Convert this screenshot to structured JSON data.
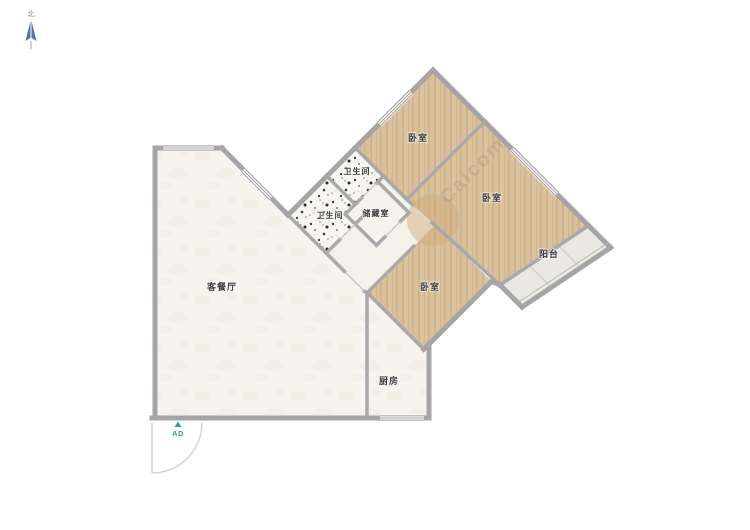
{
  "floorplan": {
    "compass_label": "北",
    "entry_marker": "AD",
    "watermark": "Caicom",
    "rooms": [
      {
        "id": "bedroom-top",
        "label": "卧室"
      },
      {
        "id": "bedroom-right",
        "label": "卧室"
      },
      {
        "id": "bedroom-lower",
        "label": "卧室"
      },
      {
        "id": "bathroom-upper",
        "label": "卫生间"
      },
      {
        "id": "bathroom-lower",
        "label": "卫生间"
      },
      {
        "id": "storage",
        "label": "储藏室"
      },
      {
        "id": "balcony",
        "label": "阳台"
      },
      {
        "id": "living-dining",
        "label": "客餐厅"
      },
      {
        "id": "kitchen",
        "label": "厨房"
      }
    ],
    "colors": {
      "wall": "#a5a5a5",
      "wood_floor": "#d9c09c",
      "tile_floor": "#f7f5f1",
      "living_floor": "#f7f4ee",
      "balcony_floor": "#eae8e3",
      "compass_blue": "#5470a8",
      "marker_teal": "#2e9e9e",
      "label_text": "#3d3d3d"
    }
  }
}
